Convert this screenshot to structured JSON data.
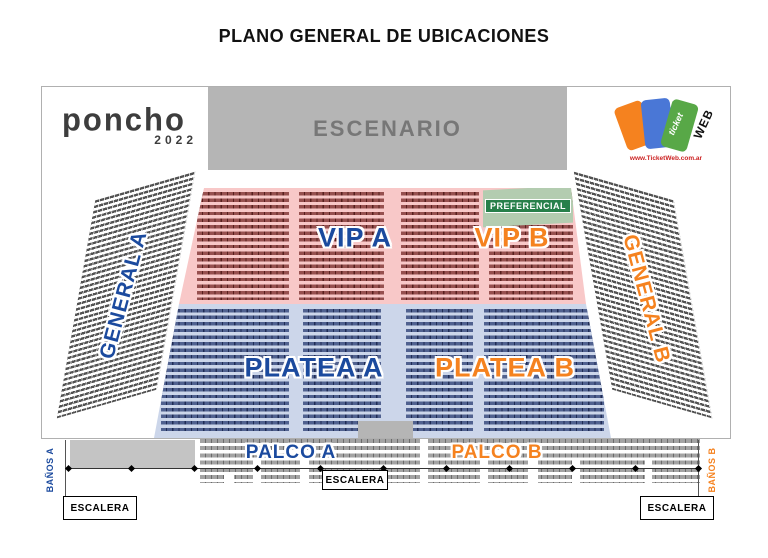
{
  "title": "PLANO GENERAL DE UBICACIONES",
  "stage": {
    "label": "ESCENARIO"
  },
  "logos": {
    "poncho": {
      "name": "poncho",
      "year": "2022"
    },
    "ticketweb": {
      "ticket": "ticket",
      "web": "WEB",
      "url": "www.TicketWeb.com.ar"
    }
  },
  "sections": {
    "general_a": {
      "label": "GENERAL A"
    },
    "general_b": {
      "label": "GENERAL B"
    },
    "vip_a": {
      "label": "VIP A"
    },
    "vip_b": {
      "label": "VIP B"
    },
    "preferencial": {
      "label": "PREFERENCIAL"
    },
    "platea_a": {
      "label": "PLATEA A"
    },
    "platea_b": {
      "label": "PLATEA B"
    },
    "palco_a": {
      "label": "PALCO A"
    },
    "palco_b": {
      "label": "PALCO B"
    },
    "banos_a": {
      "label": "BAÑOS A"
    },
    "banos_b": {
      "label": "BAÑOS B"
    }
  },
  "stairs": {
    "left": "ESCALERA",
    "center": "ESCALERA",
    "right": "ESCALERA"
  },
  "colors": {
    "label_blue": "#1b4a9e",
    "label_orange": "#f5821f",
    "preferencial_green": "#27804a",
    "stage_gray": "#b5b5b5",
    "vip_bg": "#f8c8c8",
    "platea_bg": "#ccd6ea"
  }
}
